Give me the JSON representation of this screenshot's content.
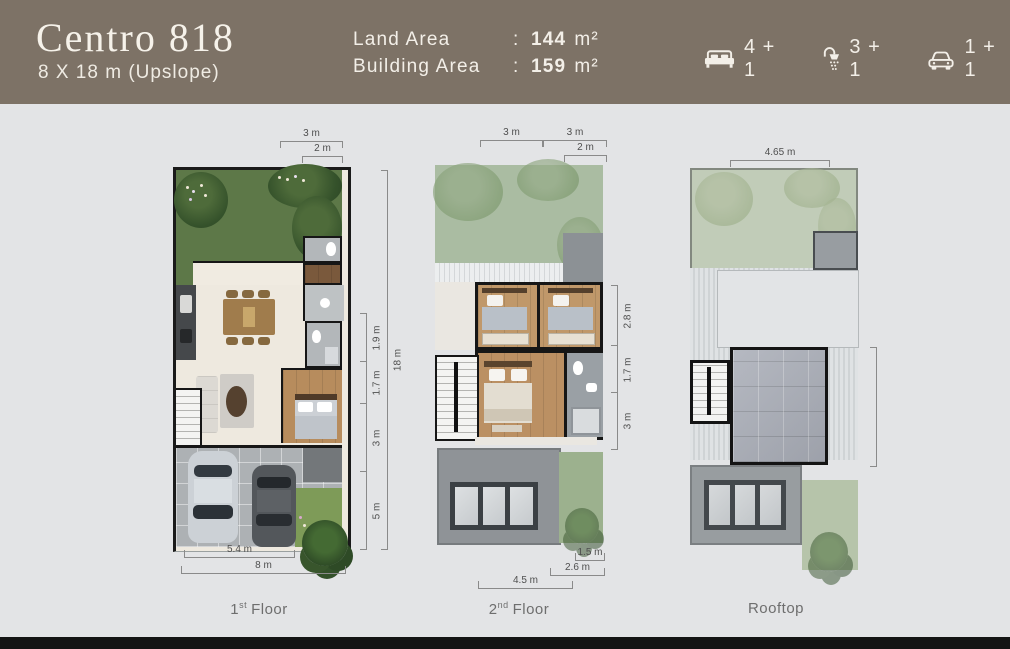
{
  "header": {
    "title": "Centro 818",
    "subtitle": "8 X 18 m (Upslope)",
    "specs": {
      "land_label": "Land Area",
      "land_colon": ":",
      "land_value": "144",
      "land_unit": "m²",
      "building_label": "Building Area",
      "building_colon": ":",
      "building_value": "159",
      "building_unit": "m²"
    },
    "features": {
      "bedrooms": {
        "icon": "bed-icon",
        "count": "4 + 1"
      },
      "bathrooms": {
        "icon": "shower-icon",
        "count": "3 + 1"
      },
      "carport": {
        "icon": "car-icon",
        "count": "1 + 1"
      }
    }
  },
  "plans": {
    "first": {
      "caption_num": "1",
      "caption_ord": "st",
      "caption_word": "Floor",
      "dim_top_outer": "3 m",
      "dim_top_inner": "2 m",
      "dim_right_seg1": "1.9 m",
      "dim_right_seg2": "1.7 m",
      "dim_right_seg3": "3 m",
      "dim_right_seg4": "5 m",
      "dim_right_total": "18 m",
      "dim_bottom_inner": "5.4 m",
      "dim_bottom_outer": "8 m"
    },
    "second": {
      "caption_num": "2",
      "caption_ord": "nd",
      "caption_word": "Floor",
      "dim_top_left": "3 m",
      "dim_top_right": "3 m",
      "dim_top_inner": "2 m",
      "dim_right_seg1": "2.8 m",
      "dim_right_seg2": "1.7 m",
      "dim_right_seg3": "3 m",
      "dim_bottom_inner": "1.5 m",
      "dim_bottom_mid": "2.6 m",
      "dim_bottom_outer": "4.5 m"
    },
    "rooftop": {
      "caption_word": "Rooftop",
      "dim_top": "4.65 m"
    }
  },
  "colors": {
    "header_bg": "#7d7266",
    "header_text": "#f3efe8",
    "canvas_bg": "#e3e4e6",
    "footer_bar": "#141414",
    "garden_green": "#5d7848",
    "faded_green": "#aabca2",
    "rooftop_green": "#c1ccb8",
    "wall_black": "#1a1a1a",
    "wood_floor": "#bb9265",
    "dim_line": "#8a8a8a"
  }
}
